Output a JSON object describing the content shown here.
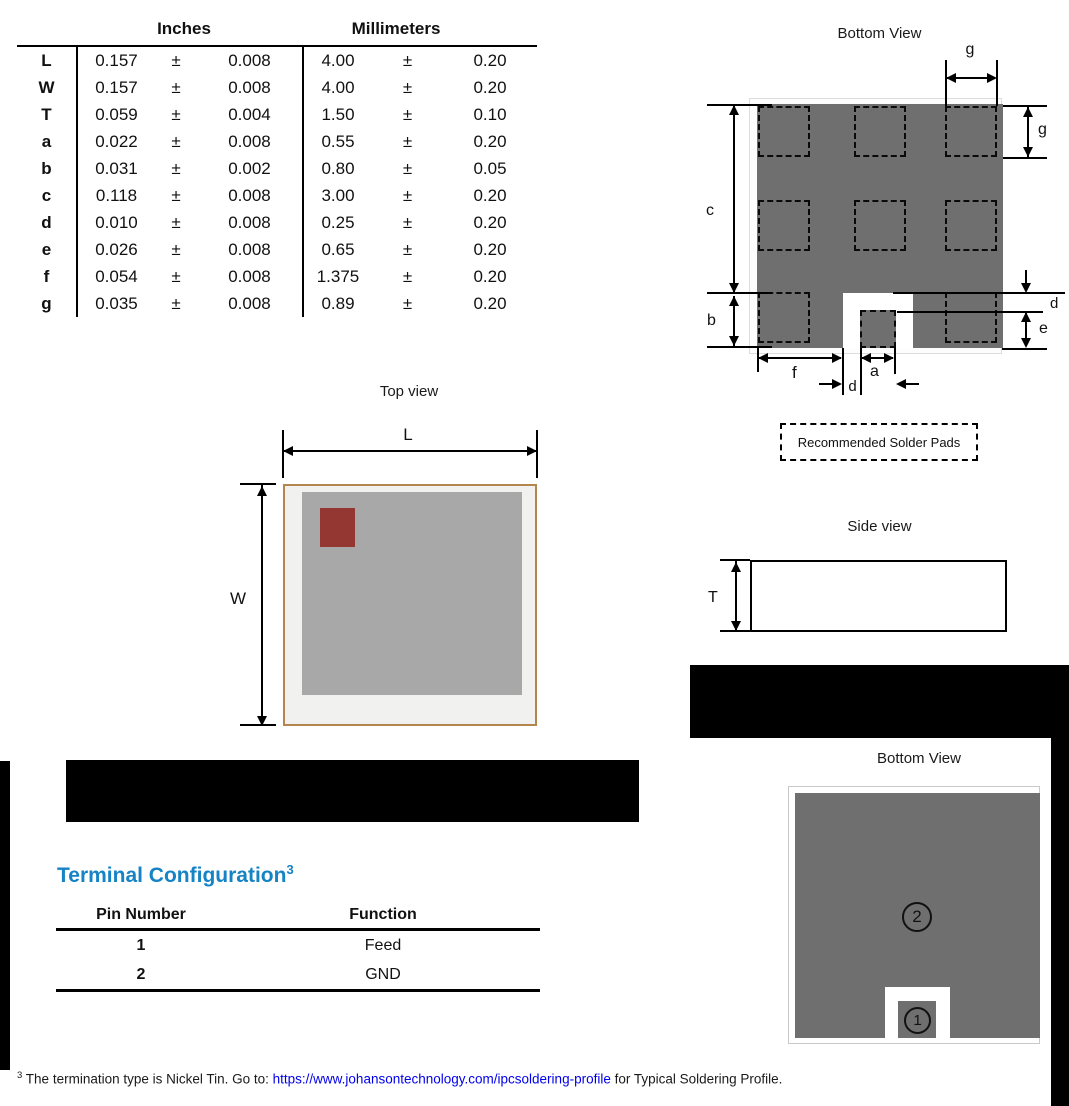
{
  "dim_table": {
    "inches_header": "Inches",
    "mm_header": "Millimeters",
    "rows": [
      {
        "label": "L",
        "in": "0.157",
        "pm": "±",
        "in_tol": "0.008",
        "mm": "4.00",
        "mm_tol": "0.20"
      },
      {
        "label": "W",
        "in": "0.157",
        "pm": "±",
        "in_tol": "0.008",
        "mm": "4.00",
        "mm_tol": "0.20"
      },
      {
        "label": "T",
        "in": "0.059",
        "pm": "±",
        "in_tol": "0.004",
        "mm": "1.50",
        "mm_tol": "0.10"
      },
      {
        "label": "a",
        "in": "0.022",
        "pm": "±",
        "in_tol": "0.008",
        "mm": "0.55",
        "mm_tol": "0.20"
      },
      {
        "label": "b",
        "in": "0.031",
        "pm": "±",
        "in_tol": "0.002",
        "mm": "0.80",
        "mm_tol": "0.05"
      },
      {
        "label": "c",
        "in": "0.118",
        "pm": "±",
        "in_tol": "0.008",
        "mm": "3.00",
        "mm_tol": "0.20"
      },
      {
        "label": "d",
        "in": "0.010",
        "pm": "±",
        "in_tol": "0.008",
        "mm": "0.25",
        "mm_tol": "0.20"
      },
      {
        "label": "e",
        "in": "0.026",
        "pm": "±",
        "in_tol": "0.008",
        "mm": "0.65",
        "mm_tol": "0.20"
      },
      {
        "label": "f",
        "in": "0.054",
        "pm": "±",
        "in_tol": "0.008",
        "mm": "1.375",
        "mm_tol": "0.20"
      },
      {
        "label": "g",
        "in": "0.035",
        "pm": "±",
        "in_tol": "0.008",
        "mm": "0.89",
        "mm_tol": "0.20"
      }
    ]
  },
  "bottom_view": {
    "title": "Bottom View",
    "labels": {
      "c": "c",
      "b": "b",
      "g_top": "g",
      "g_right": "g",
      "d_right": "d",
      "e": "e",
      "f": "f",
      "a": "a",
      "d_bottom": "d"
    },
    "solder_note": "Recommended Solder Pads"
  },
  "top_view": {
    "title": "Top view",
    "l": "L",
    "w": "W"
  },
  "side_view": {
    "title": "Side view",
    "t": "T"
  },
  "terminal_view": {
    "title": "Bottom View",
    "pin1": "1",
    "pin2": "2"
  },
  "terminal_config": {
    "heading": "Terminal Configuration",
    "heading_sup": "3",
    "col_pin": "Pin Number",
    "col_fn": "Function",
    "rows": [
      {
        "pin": "1",
        "fn": "Feed"
      },
      {
        "pin": "2",
        "fn": "GND"
      }
    ]
  },
  "footnote": {
    "sup": "3",
    "pre": " The termination type is Nickel Tin. Go to: ",
    "link": "https://www.johansontechnology.com/ipcsoldering-profile",
    "post": " for Typical Soldering Profile."
  },
  "colors": {
    "heading_blue": "#1583c5",
    "link_blue": "#0000ee",
    "metal_gray": "#6f6f6f",
    "body_gray": "#a8a8a8",
    "mark_red": "#943631",
    "chip_border_tan": "#b5854f"
  }
}
